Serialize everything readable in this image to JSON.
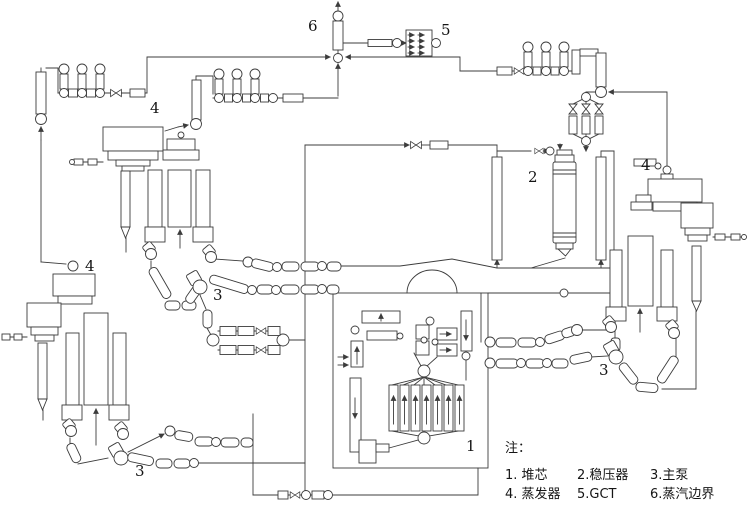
{
  "labels": {
    "core": "1",
    "pressurizer": "2",
    "pump_left": "3",
    "pump_bottom_left": "3",
    "pump_right": "3",
    "sg_top_left": "4",
    "sg_bottom_left": "4",
    "sg_right": "4",
    "gct": "5",
    "steam_boundary": "6"
  },
  "legend": {
    "title": "注：",
    "items": [
      {
        "text": "1. 堆芯"
      },
      {
        "text": "2.稳压器"
      },
      {
        "text": "3.主泵"
      },
      {
        "text": "4. 蒸发器"
      },
      {
        "text": "5.GCT"
      },
      {
        "text": "6.蒸汽边界"
      }
    ]
  },
  "colors": {
    "line": "#3c3c3c",
    "background": "#ffffff",
    "text": "#151515"
  }
}
